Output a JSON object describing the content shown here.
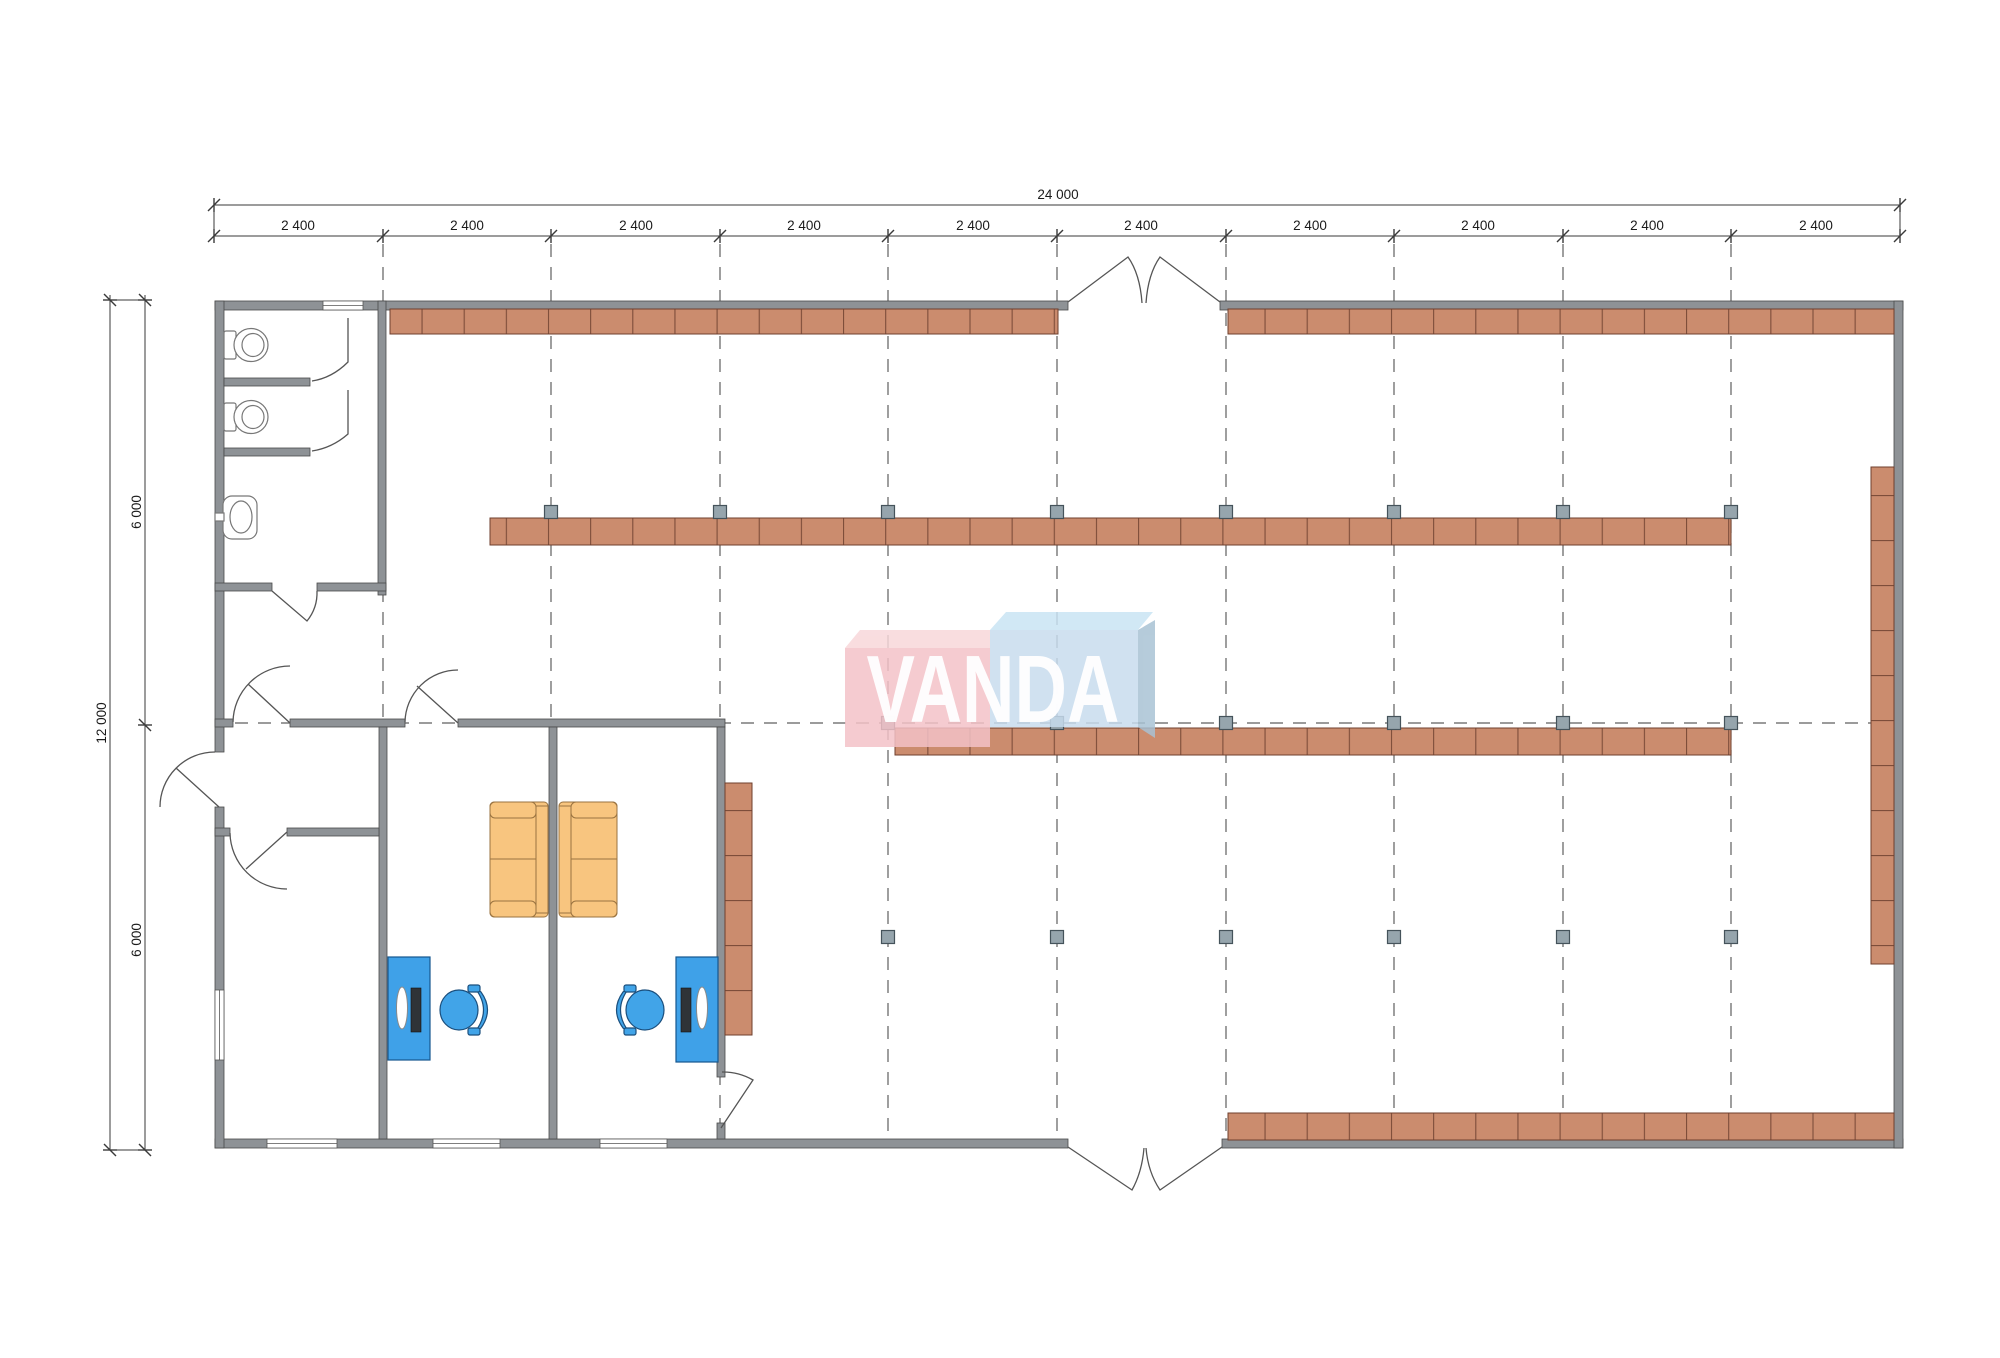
{
  "drawing": {
    "kind": "retail-store-floor-plan",
    "watermark": {
      "text": "VANDA"
    }
  },
  "dimensions": {
    "top_overall": "24 000",
    "top_bay": "2 400",
    "top_bay_count": 10,
    "left_overall": "12 000",
    "left_half": "6 000",
    "left_half_count": 2
  },
  "colors": {
    "wall": "#8E9296",
    "shelf": "#CB8C6E",
    "shelf_line": "#7d4d3a",
    "column_marker": "#96A5AD",
    "desk": "#3FA1E8",
    "chair": "#41A4E8",
    "sofa": "#F8C57F",
    "watermark_pink": "#F4C2C8",
    "watermark_pink_top": "#F8D7DA",
    "watermark_blue": "#C8DCEE",
    "watermark_blue_top": "#C9E4F4",
    "watermark_text": "#FFFFFF",
    "dimension_text": "#1a1a1a"
  }
}
